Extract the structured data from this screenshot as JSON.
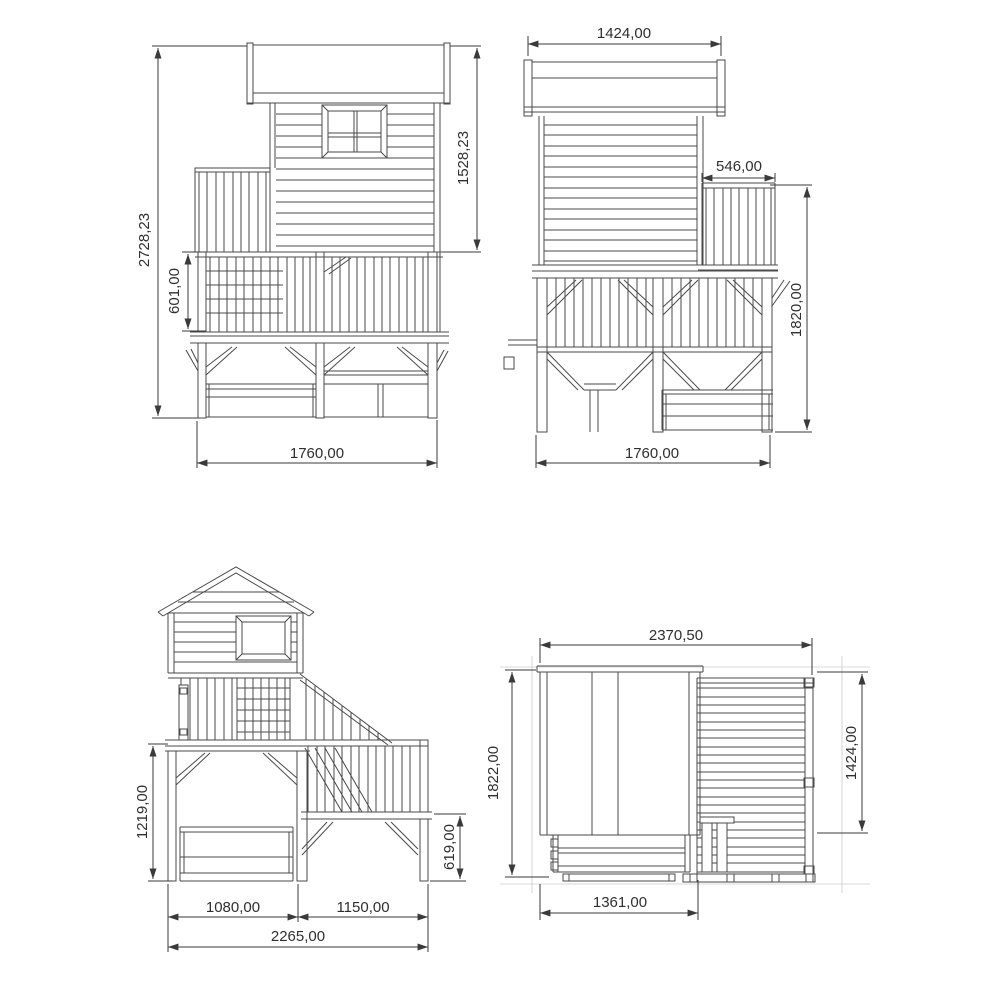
{
  "views": {
    "front_elevation": {
      "dims": {
        "total_height": "2728,23",
        "house_height": "1528,23",
        "railing_height": "601,00",
        "width": "1760,00"
      }
    },
    "side_elevation": {
      "dims": {
        "roof_length": "1424,00",
        "balcony_depth": "546,00",
        "platform_height": "1820,00",
        "width": "1760,00"
      }
    },
    "stair_elevation": {
      "dims": {
        "deck_height": "1219,00",
        "landing_height": "619,00",
        "tower_width": "1080,00",
        "stair_width": "1150,00",
        "total_width": "2265,00"
      }
    },
    "plan_view": {
      "dims": {
        "total_width": "2370,50",
        "total_depth": "1822,00",
        "deck_depth": "1424,00",
        "roof_width": "1361,00"
      }
    }
  },
  "style": {
    "background": "#ffffff",
    "structure_line": "#4a4a4a",
    "dimension_line": "#3a3a3a",
    "text_color": "#2f2f2f",
    "guide_line": "#cccccc"
  }
}
